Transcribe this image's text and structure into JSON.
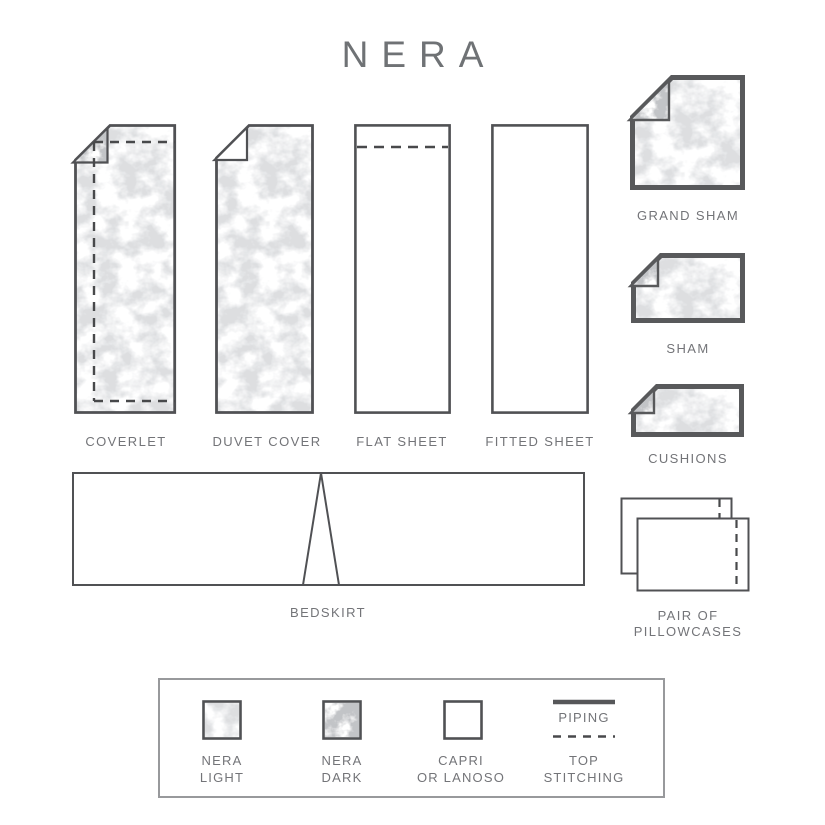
{
  "title": "NERA",
  "colors": {
    "title_text": "#6f7275",
    "label_text": "#737478",
    "thin_border": "#505154",
    "thick_border": "#58595b",
    "stitch_dash": "#48494b",
    "legend_border": "#98999c",
    "pattern_light": "#b9bbbe",
    "pattern_dark": "#8e9093"
  },
  "items": {
    "coverlet": {
      "label": "COVERLET"
    },
    "duvet": {
      "label": "DUVET COVER"
    },
    "flat_sheet": {
      "label": "FLAT SHEET"
    },
    "fitted_sheet": {
      "label": "FITTED SHEET"
    },
    "grand_sham": {
      "label": "GRAND SHAM"
    },
    "sham": {
      "label": "SHAM"
    },
    "cushions": {
      "label": "CUSHIONS"
    },
    "bedskirt": {
      "label": "BEDSKIRT"
    },
    "pillowcases": {
      "label_line1": "PAIR OF",
      "label_line2": "PILLOWCASES"
    }
  },
  "legend": {
    "nera_light": {
      "line1": "NERA",
      "line2": "LIGHT"
    },
    "nera_dark": {
      "line1": "NERA",
      "line2": "DARK"
    },
    "capri": {
      "line1": "CAPRI",
      "line2": "OR LANOSO"
    },
    "piping": {
      "label": "PIPING"
    },
    "top_stitching": {
      "line1": "TOP",
      "line2": "STITCHING"
    }
  }
}
